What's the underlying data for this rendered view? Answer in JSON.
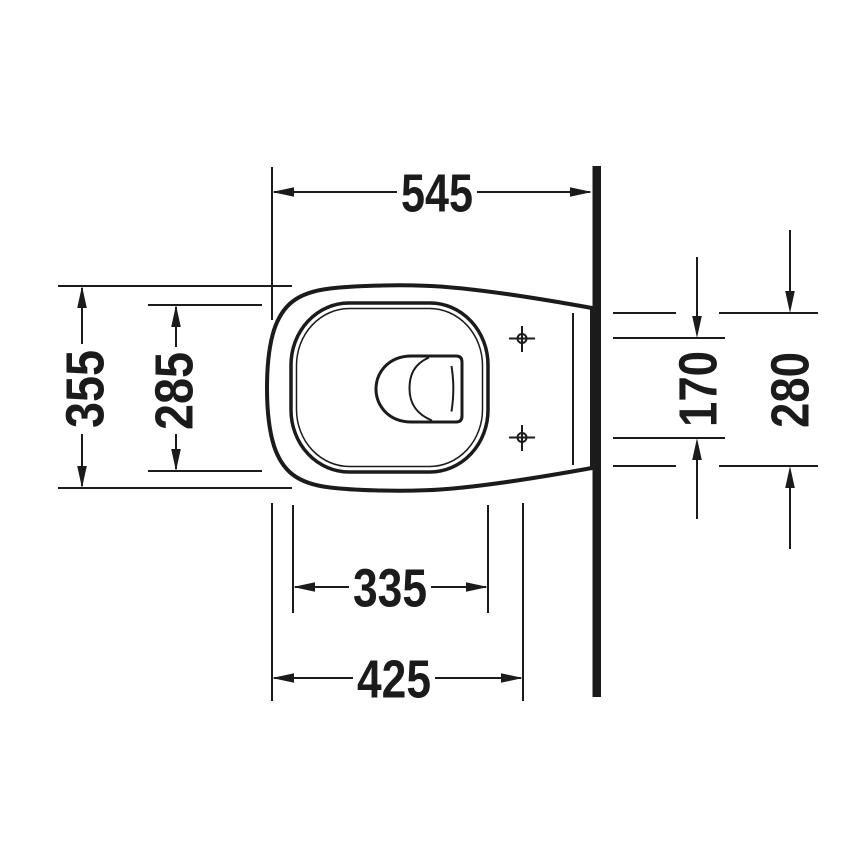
{
  "diagram": {
    "kind": "technical-dimension-drawing",
    "subject": "wall-hung-toilet-top-view",
    "background_color": "#ffffff",
    "line_color": "#1b1b1b",
    "dimensions": {
      "overall_depth_front_to_wall": "545",
      "overall_width": "355",
      "seat_opening_width": "285",
      "mounting_hole_spacing": "170",
      "rear_body_width_at_wall": "280",
      "seat_opening_depth": "335",
      "front_to_mounting_holes": "425"
    }
  }
}
